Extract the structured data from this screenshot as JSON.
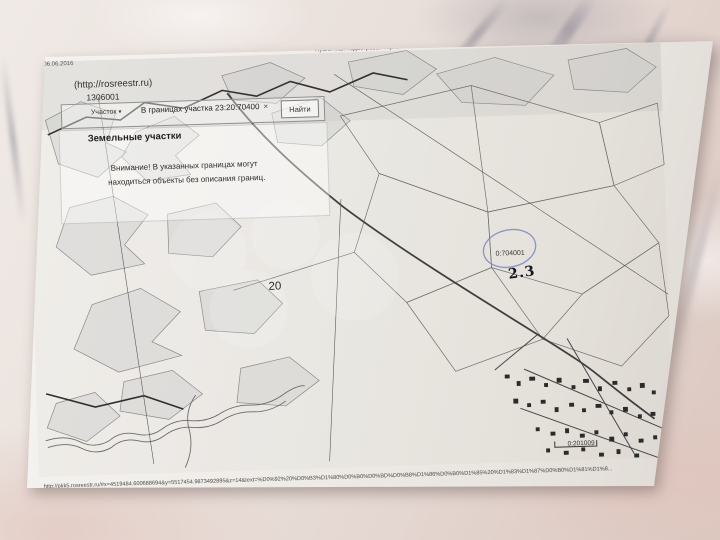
{
  "photo": {
    "header": {
      "date": "06.06.2016",
      "title": "Публичная кадастровая карта"
    },
    "map_ui": {
      "source": "(http://rosreestr.ru)",
      "ref_number": "1306001",
      "layer_dropdown": "Участок",
      "dropdown_caret": "▾",
      "search_value": "В границах участка 23:20:70400",
      "clear_icon": "×",
      "find_button": "Найти",
      "section_tab": "Земельные участки",
      "warning_line1": "Внимание! В указанных границах могут",
      "warning_line2": "находиться объекты без описания границ."
    },
    "map_labels": {
      "district_number": "20",
      "parcel_circled": "0:704001",
      "parcel_bottom": "0:201009",
      "handwritten_mark": "2.3"
    },
    "annotations": {
      "handwritten_name": "Чубская"
    },
    "footer": {
      "url": "http://pkk5.rosreestr.ru/#x=4519484.600688694&y=5517454.9873492895&z=14&text=%D0%92%20%D0%B3%D1%80%D0%B0%D0%BD%D0%B8%D1%86%D0%B0%D1%85%20%D1%83%D1%87%D0%B0%D1%81%D1%8...",
      "page": "1/2"
    },
    "colors": {
      "pen_blue": "#4b589f",
      "pencil_circle": "#7e88c4",
      "paper": "#f4f2ef"
    }
  }
}
